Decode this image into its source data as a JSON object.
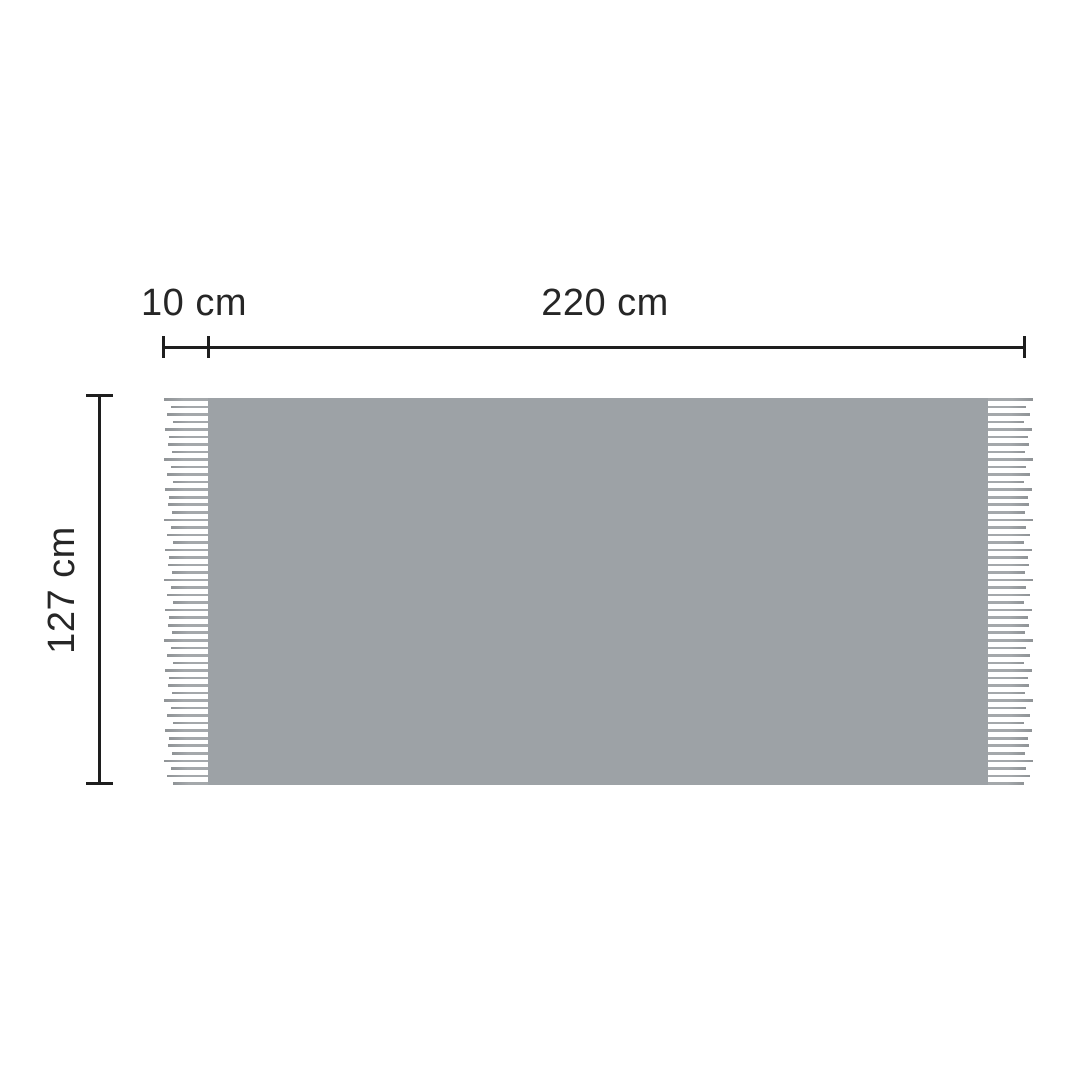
{
  "diagram": {
    "type": "product-dimension-diagram",
    "dimensions": {
      "fringe_width_label": "10 cm",
      "width_label": "220 cm",
      "height_label": "127 cm"
    },
    "colors": {
      "background": "#ffffff",
      "blanket_fill": "#9da2a6",
      "fringe_strand": "#a4a8ab",
      "fringe_strand_tip": "#8f9396",
      "line": "#1e1e1e",
      "text": "#262626"
    },
    "fringe": {
      "strands_per_side": 52,
      "sides": [
        "left",
        "right"
      ]
    }
  }
}
